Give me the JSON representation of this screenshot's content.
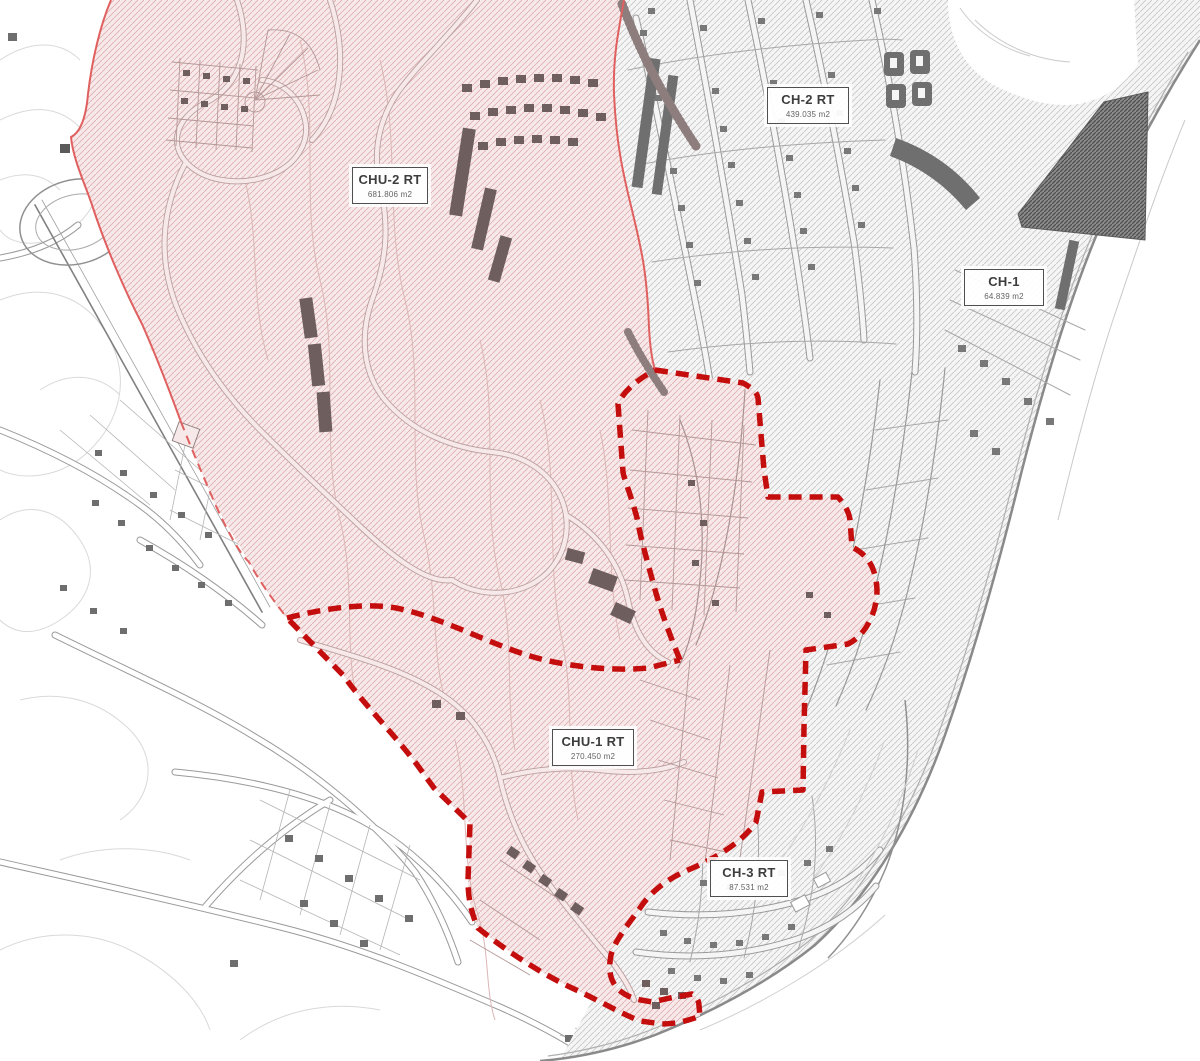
{
  "zones": {
    "chu2": {
      "name": "CHU-2 RT",
      "area": "681.806 m2"
    },
    "ch2": {
      "name": "CH-2 RT",
      "area": "439.035 m2"
    },
    "ch1": {
      "name": "CH-1",
      "area": "64.839 m2"
    },
    "chu1": {
      "name": "CHU-1 RT",
      "area": "270.450 m2"
    },
    "ch3": {
      "name": "CH-3 RT",
      "area": "87.531 m2"
    }
  },
  "palette": {
    "boundary_red": "#c40d0d",
    "boundary_thin": "#e06060",
    "label_border": "#4f4f4f",
    "pink_fill": "#f7e9e9",
    "pink_hatch": "#deb0b0",
    "gray_fill": "#f5f5f5",
    "gray_hatch": "#c8c8c8",
    "dark_hatch": "#4f4f4f",
    "building_dark": "#6e5e5e",
    "building_gray": "#787878",
    "line_gray": "#9a9a9a",
    "contour_gray": "#d9d9d9"
  }
}
